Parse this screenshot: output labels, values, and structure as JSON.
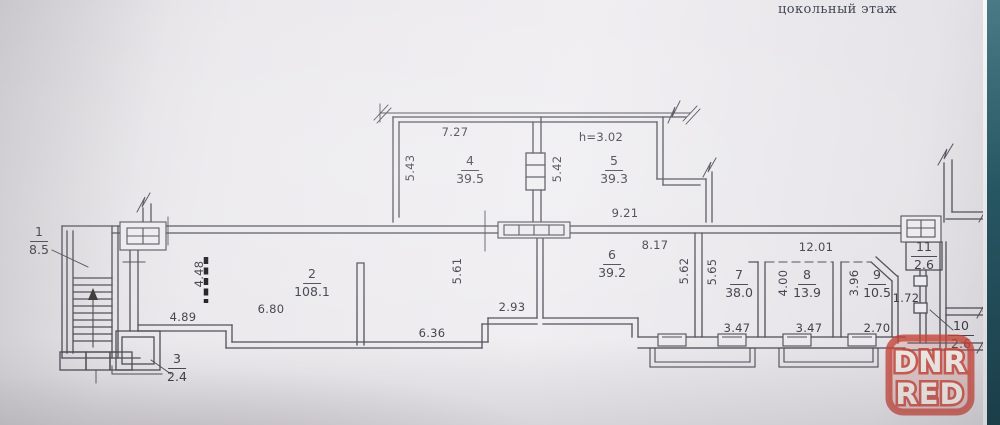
{
  "title": "цокольный этаж",
  "watermark": {
    "line1": "DNR",
    "line2": "RED"
  },
  "rooms": {
    "r1": {
      "num": "1",
      "area": "8.5"
    },
    "r2": {
      "num": "2",
      "area": "108.1"
    },
    "r3": {
      "num": "3",
      "area": "2.4"
    },
    "r4": {
      "num": "4",
      "area": "39.5"
    },
    "r5": {
      "num": "5",
      "area": "39.3"
    },
    "r6": {
      "num": "6",
      "area": "39.2"
    },
    "r7": {
      "num": "7",
      "area": "38.0"
    },
    "r8": {
      "num": "8",
      "area": "13.9"
    },
    "r9": {
      "num": "9",
      "area": "10.5"
    },
    "r10": {
      "num": "10",
      "area": "2.6"
    },
    "r11": {
      "num": "11",
      "area": "2.6"
    }
  },
  "dims": {
    "room4_width": "7.27",
    "room4_depth": "5.43",
    "divider_4_5": "5.42",
    "ceiling_height": "h=3.02",
    "room5_width": "9.21",
    "room6_width": "8.17",
    "stair_side": "4.48",
    "hall_left": "4.89",
    "hall_depth": "6.80",
    "hall_step": "2.93",
    "hall_height": "5.61",
    "hall_bottom": "6.36",
    "room6_depth": "5.62",
    "corridor_width": "12.01",
    "room7_depth": "5.65",
    "room7_width": "3.47",
    "room8_depth": "4.00",
    "room8_width": "3.47",
    "room9_depth": "3.96",
    "room9_width": "2.70",
    "shaft_width": "1.72"
  },
  "colors": {
    "ink": "#4a4a54",
    "paper": "#eae8eb",
    "watermark_red": "#c44236",
    "table_edge_teal": "#2b5a66"
  }
}
